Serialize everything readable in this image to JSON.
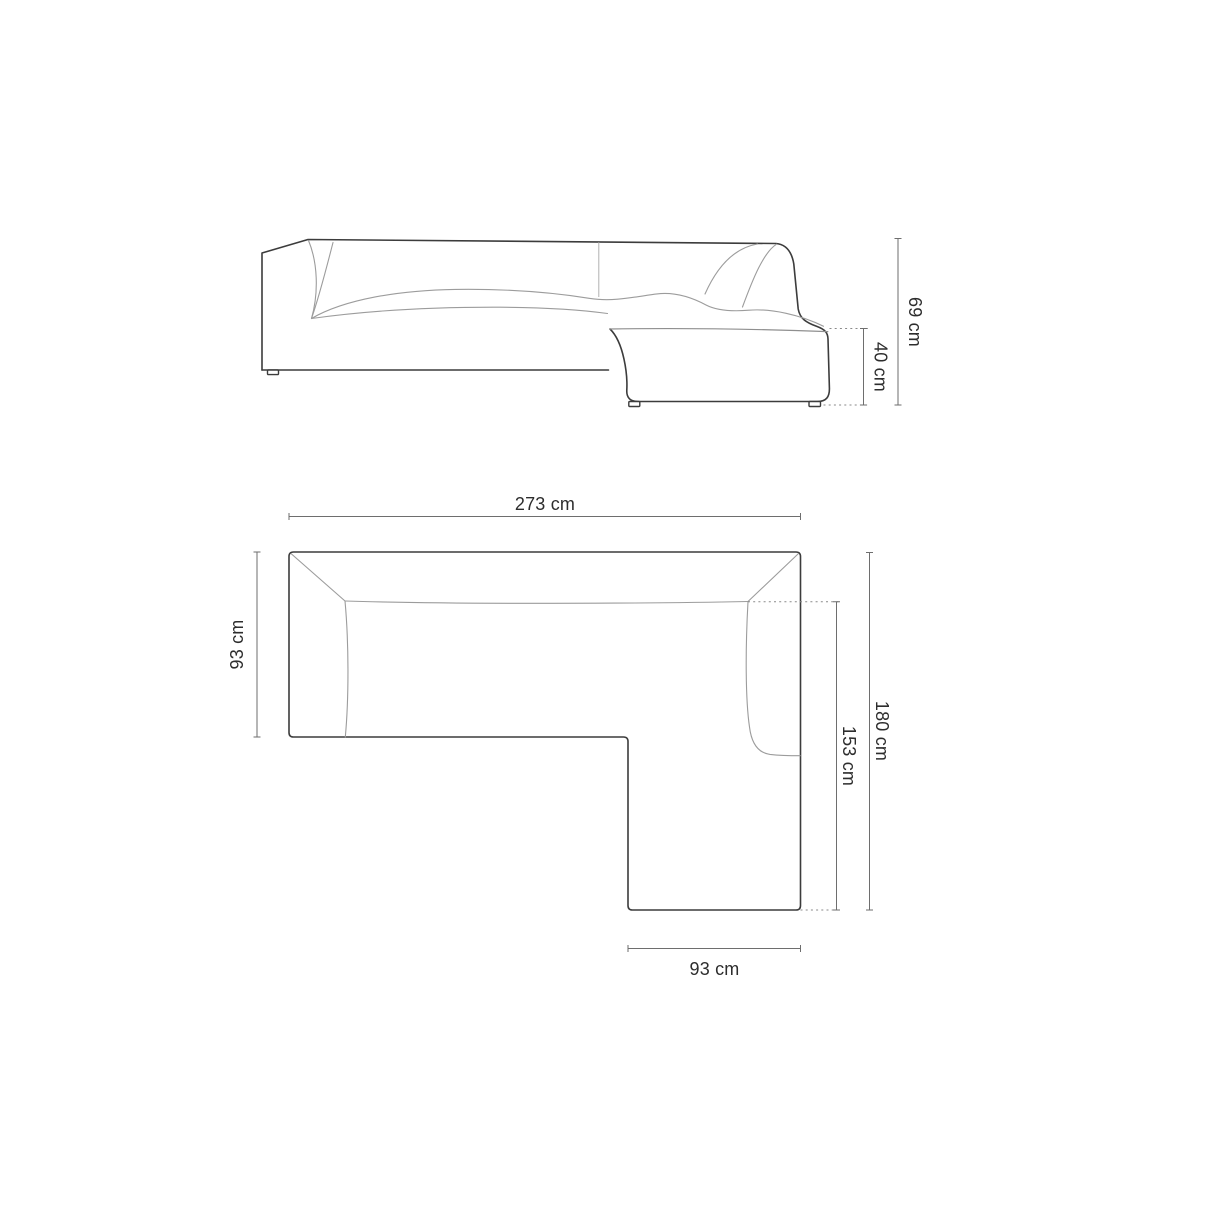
{
  "diagram": {
    "elevation": {
      "dimensions": {
        "total_height": {
          "label": "69 cm"
        },
        "seat_height": {
          "label": "40 cm"
        }
      }
    },
    "plan": {
      "dimensions": {
        "total_width": {
          "label": "273 cm"
        },
        "sofa_depth": {
          "label": "93 cm"
        },
        "total_side": {
          "label": "180 cm"
        },
        "chaise_side": {
          "label": "153 cm"
        },
        "chaise_width": {
          "label": "93 cm"
        }
      }
    }
  },
  "colors": {
    "background": "#ffffff",
    "outline": "#3c3c3c",
    "thin_line": "#9c9c9c",
    "dimension_line": "#6e6e6e",
    "label_text": "#2d2d2d"
  }
}
